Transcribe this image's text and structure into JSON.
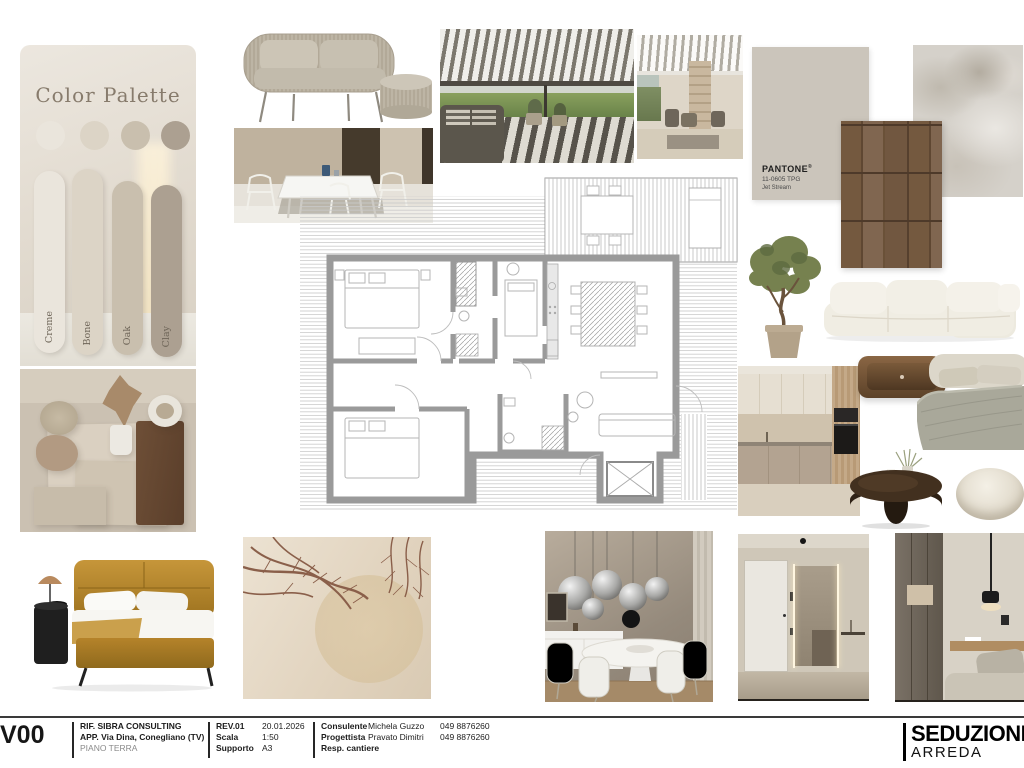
{
  "palette": {
    "title": "Color Palette",
    "swatches": [
      {
        "label": "Creme",
        "color": "#eae5dc"
      },
      {
        "label": "Bone",
        "color": "#dcd4c6"
      },
      {
        "label": "Oak",
        "color": "#c9bfae"
      },
      {
        "label": "Clay",
        "color": "#aca091"
      }
    ]
  },
  "pantone": {
    "brand": "PANTONE",
    "registered": "®",
    "code": "11-0605 TPG",
    "name": "Jet Stream"
  },
  "titleblock": {
    "sheet_code": "V00",
    "project": {
      "line1": "RIF. SIBRA CONSULTING",
      "line2": "APP. Via Dina, Conegliano (TV)",
      "line3": "PIANO TERRA"
    },
    "revision": [
      {
        "label": "REV.01",
        "value": "20.01.2026"
      },
      {
        "label": "Scala",
        "value": "1:50"
      },
      {
        "label": "Supporto",
        "value": "A3"
      }
    ],
    "roles": [
      {
        "label": "Consulente"
      },
      {
        "label": "Progettista"
      },
      {
        "label": "Resp. cantiere"
      }
    ],
    "contacts": [
      {
        "name": "Michela Guzzo",
        "phone": "049 8876260"
      },
      {
        "name": "Pravato Dimitri",
        "phone": "049 8876260"
      }
    ]
  },
  "logo": {
    "line1": "SEDUZIONE",
    "line2": "ARREDA"
  }
}
